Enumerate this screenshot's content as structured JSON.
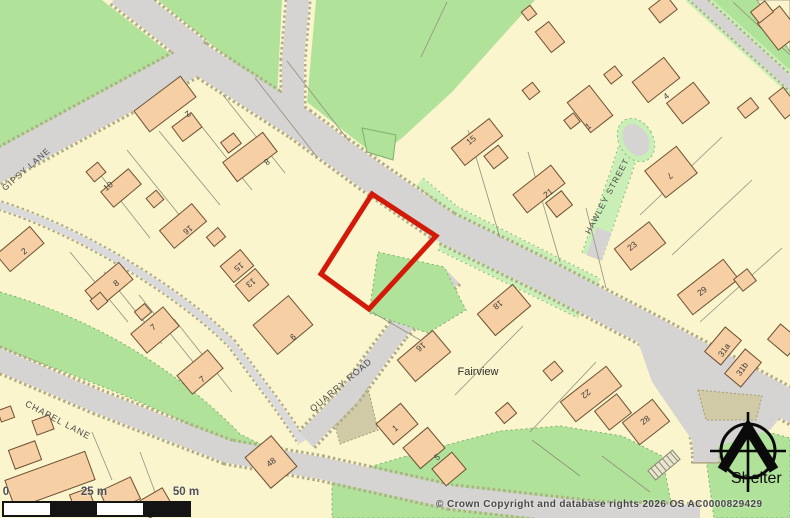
{
  "map": {
    "street_labels": [
      {
        "text": "GIPSY LANE"
      },
      {
        "text": "CHAPEL LANE"
      },
      {
        "text": "QUARRY ROAD"
      },
      {
        "text": "HAWLEY STREET"
      }
    ],
    "place_labels": [
      {
        "text": "Fairview"
      }
    ],
    "house_numbers": [
      {
        "text": "2"
      },
      {
        "text": "8"
      },
      {
        "text": "10"
      },
      {
        "text": "16"
      },
      {
        "text": "15"
      },
      {
        "text": "13"
      },
      {
        "text": "2"
      },
      {
        "text": "8"
      },
      {
        "text": "7"
      },
      {
        "text": "7"
      },
      {
        "text": "9"
      },
      {
        "text": "15"
      },
      {
        "text": "21"
      },
      {
        "text": "1"
      },
      {
        "text": "4"
      },
      {
        "text": "7"
      },
      {
        "text": "23"
      },
      {
        "text": "29"
      },
      {
        "text": "31a"
      },
      {
        "text": "31b"
      },
      {
        "text": "16"
      },
      {
        "text": "18"
      },
      {
        "text": "1"
      },
      {
        "text": "5"
      },
      {
        "text": "48"
      },
      {
        "text": "22"
      },
      {
        "text": "28"
      }
    ],
    "colors": {
      "property_boundary": "#d31a09",
      "field_green": "#b0e29a",
      "verge_green": "#c9efb7",
      "building_fill": "#f6cfa4",
      "road_gray": "#d5d4d2",
      "parcel_cream": "#fbf5cd"
    }
  },
  "scale_bar": {
    "labels": [
      {
        "text": "0"
      },
      {
        "text": "25 m"
      },
      {
        "text": "50 m"
      }
    ]
  },
  "attribution": {
    "text": "© Crown Copyright and database rights 2026 OS AC0000829429"
  },
  "logo": {
    "text": "Shelter"
  }
}
